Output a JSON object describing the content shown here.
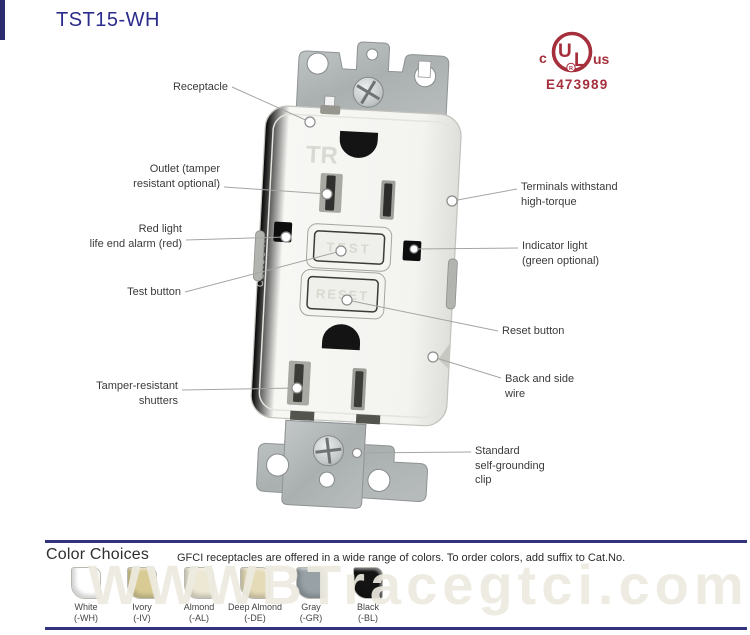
{
  "title": "TST15-WH",
  "certification": {
    "prefix": "c",
    "letter_u": "U",
    "letter_l": "L",
    "registered": "R",
    "suffix": "us",
    "file_number": "E473989",
    "color": "#a5303c"
  },
  "device": {
    "tr_marking": "TR",
    "edge_marking": "CLASS A",
    "test_button_ghost": "TEST",
    "reset_button_ghost": "RESET"
  },
  "callouts_left": [
    {
      "id": "receptacle",
      "label": "Receptacle"
    },
    {
      "id": "outlet",
      "label": "Outlet (tamper\nresistant optional)"
    },
    {
      "id": "red-light",
      "label": "Red light\nlife end alarm (red)"
    },
    {
      "id": "test-button",
      "label": "Test button"
    },
    {
      "id": "shutters",
      "label": "Tamper-resistant\nshutters"
    }
  ],
  "callouts_right": [
    {
      "id": "terminals",
      "label": "Terminals withstand\nhigh-torque"
    },
    {
      "id": "indicator",
      "label": "Indicator light\n(green optional)"
    },
    {
      "id": "reset-button",
      "label": "Reset  button"
    },
    {
      "id": "back-side-wire",
      "label": "Back and side\nwire"
    },
    {
      "id": "grounding-clip",
      "label": "Standard\nself-grounding\nclip"
    }
  ],
  "color_choices": {
    "heading": "Color Choices",
    "description": "GFCI receptacles are offered in a wide range of colors. To order colors, add suffix to Cat.No.",
    "swatches": [
      {
        "name": "White",
        "suffix": "(-WH)",
        "color": "#ffffff"
      },
      {
        "name": "Ivory",
        "suffix": "(-IV)",
        "color": "#d8cb93"
      },
      {
        "name": "Almond",
        "suffix": "(-AL)",
        "color": "#ede8d4"
      },
      {
        "name": "Deep Almond",
        "suffix": "(-DE)",
        "color": "#e5dbb7"
      },
      {
        "name": "Gray",
        "suffix": "(-GR)",
        "color": "#97a1a6"
      },
      {
        "name": "Black",
        "suffix": "(-BL)",
        "color": "#141414"
      }
    ]
  },
  "watermark": "WWWBTracegtci.com"
}
